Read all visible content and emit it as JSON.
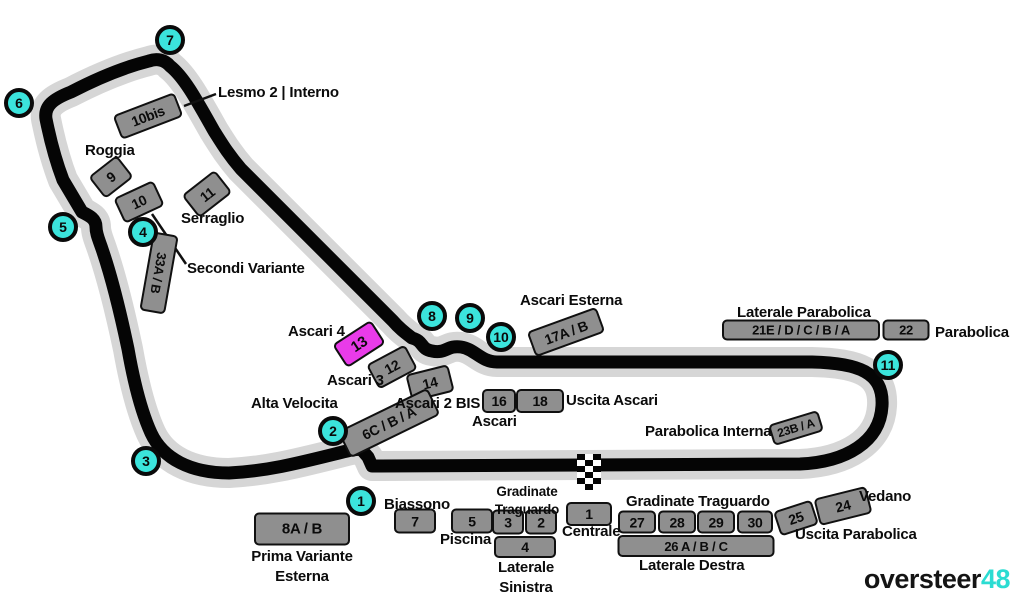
{
  "title": "Monza circuit grandstand map",
  "colors": {
    "cyan": "#3BE4DC",
    "cyan_logo": "#2BDCD2",
    "magenta": "#E93BE9",
    "track": "#050505",
    "halo": "#D6D6D6",
    "stand_gray": "#8F8F8F"
  },
  "branding": {
    "name": "oversteer",
    "number": "48"
  },
  "turns": [
    {
      "n": 1,
      "x": 361,
      "y": 501
    },
    {
      "n": 2,
      "x": 333,
      "y": 431
    },
    {
      "n": 3,
      "x": 146,
      "y": 461
    },
    {
      "n": 4,
      "x": 143,
      "y": 232
    },
    {
      "n": 5,
      "x": 63,
      "y": 227
    },
    {
      "n": 6,
      "x": 19,
      "y": 103
    },
    {
      "n": 7,
      "x": 170,
      "y": 40
    },
    {
      "n": 8,
      "x": 432,
      "y": 316
    },
    {
      "n": 9,
      "x": 470,
      "y": 318
    },
    {
      "n": 10,
      "x": 501,
      "y": 337
    },
    {
      "n": 11,
      "x": 888,
      "y": 365
    }
  ],
  "stands": [
    {
      "id": "10bis",
      "label": "10bis",
      "x": 148,
      "y": 116,
      "w": 66,
      "h": 26,
      "rot": -21,
      "fs": 14
    },
    {
      "id": "9",
      "label": "9",
      "x": 111,
      "y": 177,
      "w": 36,
      "h": 28,
      "rot": -38,
      "fs": 14
    },
    {
      "id": "10",
      "label": "10",
      "x": 139,
      "y": 202,
      "w": 44,
      "h": 28,
      "rot": -25,
      "fs": 14
    },
    {
      "id": "11",
      "label": "11",
      "x": 207,
      "y": 194,
      "w": 42,
      "h": 29,
      "rot": -38,
      "fs": 14
    },
    {
      "id": "33ab",
      "label": "33A / B",
      "x": 159,
      "y": 273,
      "w": 80,
      "h": 26,
      "rot": 100,
      "fs": 13
    },
    {
      "id": "13",
      "label": "13",
      "x": 359,
      "y": 344,
      "w": 46,
      "h": 28,
      "rot": -33,
      "fs": 15,
      "accent": true
    },
    {
      "id": "12",
      "label": "12",
      "x": 392,
      "y": 367,
      "w": 44,
      "h": 28,
      "rot": -28,
      "fs": 14
    },
    {
      "id": "14",
      "label": "14",
      "x": 430,
      "y": 383,
      "w": 44,
      "h": 28,
      "rot": -14,
      "fs": 14
    },
    {
      "id": "6cba",
      "label": "6C / B / A",
      "x": 389,
      "y": 423,
      "w": 100,
      "h": 30,
      "rot": -26,
      "fs": 14
    },
    {
      "id": "16",
      "label": "16",
      "x": 499,
      "y": 401,
      "w": 34,
      "h": 24,
      "rot": 0,
      "fs": 14
    },
    {
      "id": "18",
      "label": "18",
      "x": 540,
      "y": 401,
      "w": 48,
      "h": 24,
      "rot": 0,
      "fs": 14
    },
    {
      "id": "17ab",
      "label": "17A / B",
      "x": 566,
      "y": 332,
      "w": 74,
      "h": 27,
      "rot": -20,
      "fs": 14
    },
    {
      "id": "21edcba",
      "label": "21E / D / C / B / A",
      "x": 801,
      "y": 330,
      "w": 158,
      "h": 21,
      "rot": 0,
      "fs": 13
    },
    {
      "id": "22",
      "label": "22",
      "x": 906,
      "y": 330,
      "w": 47,
      "h": 21,
      "rot": 0,
      "fs": 13
    },
    {
      "id": "23ba",
      "label": "23B / A",
      "x": 796,
      "y": 428,
      "w": 52,
      "h": 22,
      "rot": -17,
      "fs": 12
    },
    {
      "id": "8ab",
      "label": "8A / B",
      "x": 302,
      "y": 529,
      "w": 96,
      "h": 33,
      "rot": 0,
      "fs": 15
    },
    {
      "id": "7",
      "label": "7",
      "x": 415,
      "y": 521,
      "w": 42,
      "h": 25,
      "rot": 0,
      "fs": 14
    },
    {
      "id": "5",
      "label": "5",
      "x": 472,
      "y": 521,
      "w": 42,
      "h": 25,
      "rot": 0,
      "fs": 14
    },
    {
      "id": "3",
      "label": "3",
      "x": 508,
      "y": 522,
      "w": 32,
      "h": 25,
      "rot": 0,
      "fs": 14
    },
    {
      "id": "2",
      "label": "2",
      "x": 541,
      "y": 522,
      "w": 32,
      "h": 25,
      "rot": 0,
      "fs": 14
    },
    {
      "id": "4",
      "label": "4",
      "x": 525,
      "y": 547,
      "w": 62,
      "h": 22,
      "rot": 0,
      "fs": 14
    },
    {
      "id": "1",
      "label": "1",
      "x": 589,
      "y": 514,
      "w": 46,
      "h": 24,
      "rot": 0,
      "fs": 14
    },
    {
      "id": "27",
      "label": "27",
      "x": 637,
      "y": 522,
      "w": 38,
      "h": 23,
      "rot": 0,
      "fs": 14
    },
    {
      "id": "28",
      "label": "28",
      "x": 677,
      "y": 522,
      "w": 38,
      "h": 23,
      "rot": 0,
      "fs": 14
    },
    {
      "id": "29",
      "label": "29",
      "x": 716,
      "y": 522,
      "w": 38,
      "h": 23,
      "rot": 0,
      "fs": 14
    },
    {
      "id": "30",
      "label": "30",
      "x": 755,
      "y": 522,
      "w": 36,
      "h": 23,
      "rot": 0,
      "fs": 14
    },
    {
      "id": "26abc",
      "label": "26 A / B / C",
      "x": 696,
      "y": 546,
      "w": 157,
      "h": 22,
      "rot": 0,
      "fs": 13
    },
    {
      "id": "25",
      "label": "25",
      "x": 796,
      "y": 518,
      "w": 40,
      "h": 26,
      "rot": -18,
      "fs": 14
    },
    {
      "id": "24",
      "label": "24",
      "x": 843,
      "y": 506,
      "w": 54,
      "h": 28,
      "rot": -14,
      "fs": 14
    }
  ],
  "labels": [
    {
      "id": "lesmo-2-interno",
      "text": "Lesmo 2 | Interno",
      "x": 218,
      "y": 83
    },
    {
      "id": "roggia",
      "text": "Roggia",
      "x": 85,
      "y": 141
    },
    {
      "id": "serraglio",
      "text": "Serraglio",
      "x": 181,
      "y": 209
    },
    {
      "id": "secondi-variante",
      "text": "Secondi Variante",
      "x": 187,
      "y": 259
    },
    {
      "id": "ascari-esterna",
      "text": "Ascari Esterna",
      "x": 520,
      "y": 291
    },
    {
      "id": "laterale-parabolica",
      "text": "Laterale Parabolica",
      "x": 737,
      "y": 303
    },
    {
      "id": "parabolica",
      "text": "Parabolica",
      "x": 935,
      "y": 323
    },
    {
      "id": "ascari-4",
      "text": "Ascari 4",
      "x": 288,
      "y": 322
    },
    {
      "id": "ascari-3",
      "text": "Ascari 3",
      "x": 327,
      "y": 371
    },
    {
      "id": "ascari-2-bis",
      "text": "Ascari 2 BIS",
      "x": 395,
      "y": 394
    },
    {
      "id": "alta-velocita",
      "text": "Alta Velocita",
      "x": 251,
      "y": 394
    },
    {
      "id": "ascari",
      "text": "Ascari",
      "x": 472,
      "y": 412
    },
    {
      "id": "uscita-ascari",
      "text": "Uscita Ascari",
      "x": 566,
      "y": 391
    },
    {
      "id": "parabolica-interna",
      "text": "Parabolica Interna",
      "x": 645,
      "y": 422
    },
    {
      "id": "biassono",
      "text": "Biassono",
      "x": 384,
      "y": 495
    },
    {
      "id": "gradinate-traguardo-left",
      "text": "Gradinate\nTraguardo",
      "x": 527,
      "y": 483,
      "center": true,
      "size": 13.5
    },
    {
      "id": "piscina",
      "text": "Piscina",
      "x": 440,
      "y": 530
    },
    {
      "id": "laterale-sinistra",
      "text": "Laterale\nSinistra",
      "x": 526,
      "y": 558,
      "center": true
    },
    {
      "id": "centrale",
      "text": "Centrale",
      "x": 562,
      "y": 522
    },
    {
      "id": "gradinate-traguardo-right",
      "text": "Gradinate Traguardo",
      "x": 626,
      "y": 492
    },
    {
      "id": "laterale-destra",
      "text": "Laterale Destra",
      "x": 639,
      "y": 556
    },
    {
      "id": "vedano",
      "text": "Vedano",
      "x": 859,
      "y": 487
    },
    {
      "id": "uscita-parabolica",
      "text": "Uscita Parabolica",
      "x": 795,
      "y": 525
    },
    {
      "id": "prima-variante-esterna",
      "text": "Prima Variante\nEsterna",
      "x": 302,
      "y": 547,
      "center": true
    }
  ]
}
